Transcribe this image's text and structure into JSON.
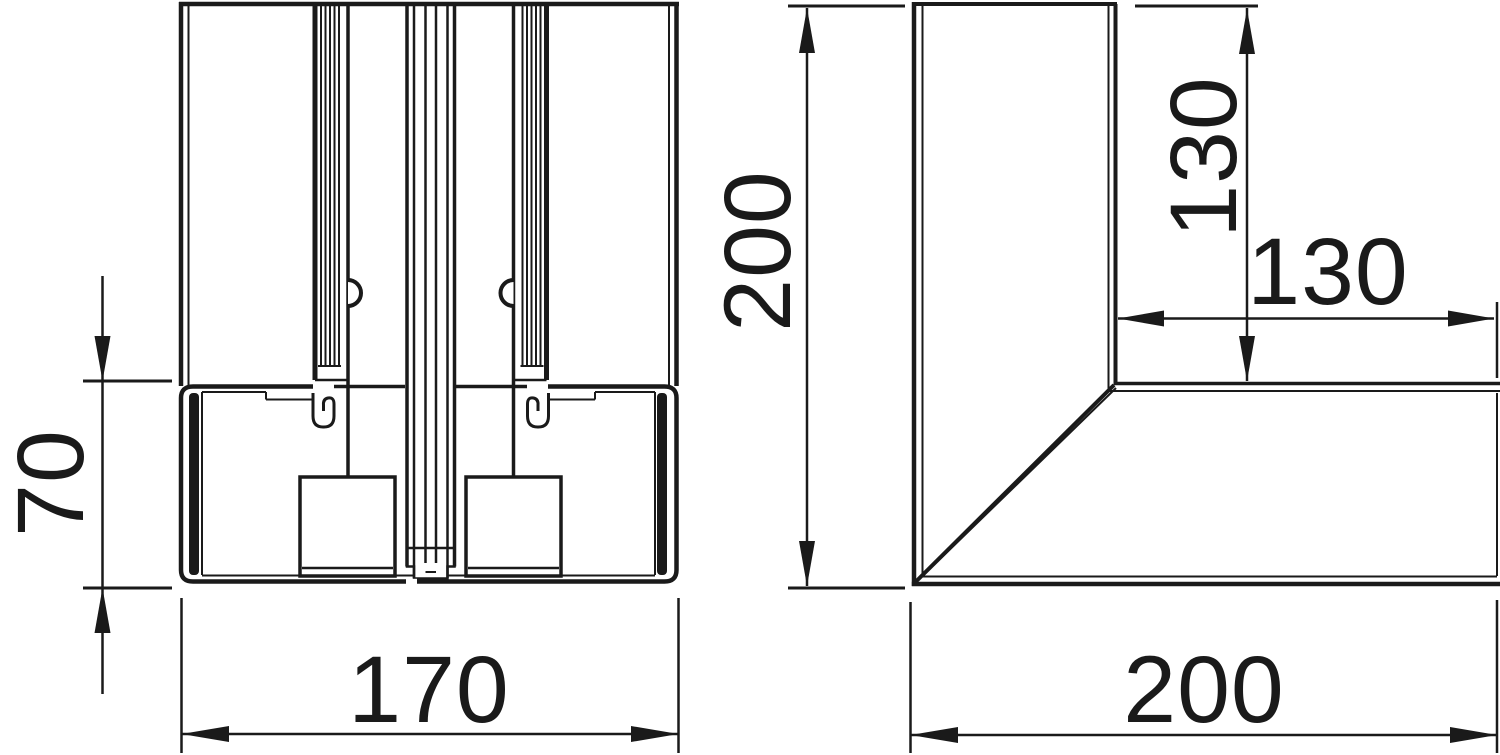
{
  "drawing": {
    "type": "technical-dimension-drawing",
    "colors": {
      "line": "#1a1a1a",
      "background": "#ffffff"
    },
    "section_view": {
      "name": "trunking-cross-section",
      "dim_base_height": "70",
      "dim_base_width": "170",
      "dim_overall_height": "200"
    },
    "corner_view": {
      "name": "trunking-corner-piece",
      "dim_leg_vertical": "130",
      "dim_leg_horizontal": "130",
      "dim_overall_width": "200"
    }
  }
}
